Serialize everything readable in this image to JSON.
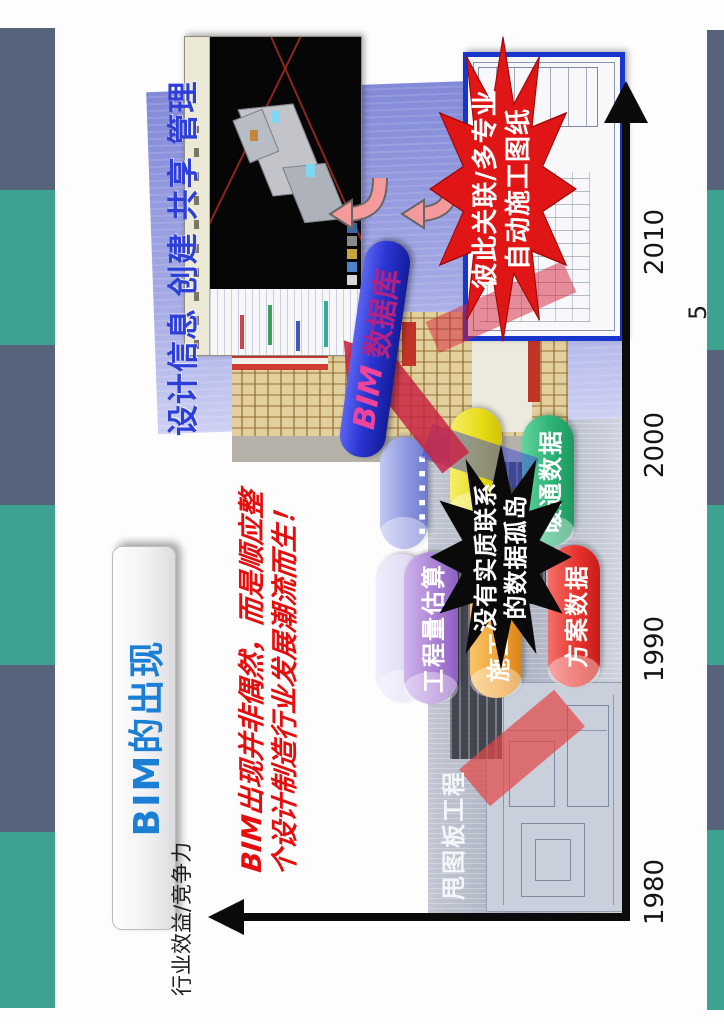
{
  "slide": {
    "page_number": "5",
    "title": "BIM的出现",
    "y_axis_label": "行业效益/竞争力",
    "years": [
      "1980",
      "1990",
      "2000",
      "2010"
    ],
    "intro": {
      "line1": "BIM出现并非偶然，而是顺应整",
      "line2": "个设计制造行业发展潮流而生！"
    },
    "panel_header": "设计信息 创建 共享 管理",
    "era_band_label": "甩图板工程",
    "ellipsis": "......",
    "bim_bar": {
      "prefix": "BIM",
      "suffix": "数据库"
    },
    "cylinders": {
      "quantity": "工程量估算",
      "construction": "施工",
      "scheme": "方案数据",
      "hvac": "暖通数据"
    },
    "black_star": {
      "line1": "没有实质联系",
      "line2": "的数据孤岛"
    },
    "red_star": {
      "line1": "彼此关联/多专业",
      "line2": "自动施工图纸"
    },
    "colors": {
      "deco_teal": "#3DA28F",
      "deco_slate": "#57637A",
      "title_blue": "#1B7FD6",
      "header_blue": "#2E3FD8",
      "accent_red": "#E60D0D",
      "bar_blue": "#2B36D2",
      "bar_text_pink": "#E8389B",
      "cyl_quantity": "#A97FD4",
      "cyl_construction": "#EFA02F",
      "cyl_scheme": "#E8342E",
      "cyl_hvac": "#2EB377",
      "cyl_yellow": "#E8DC14",
      "cyl_periwinkle": "#8A94DC"
    }
  }
}
